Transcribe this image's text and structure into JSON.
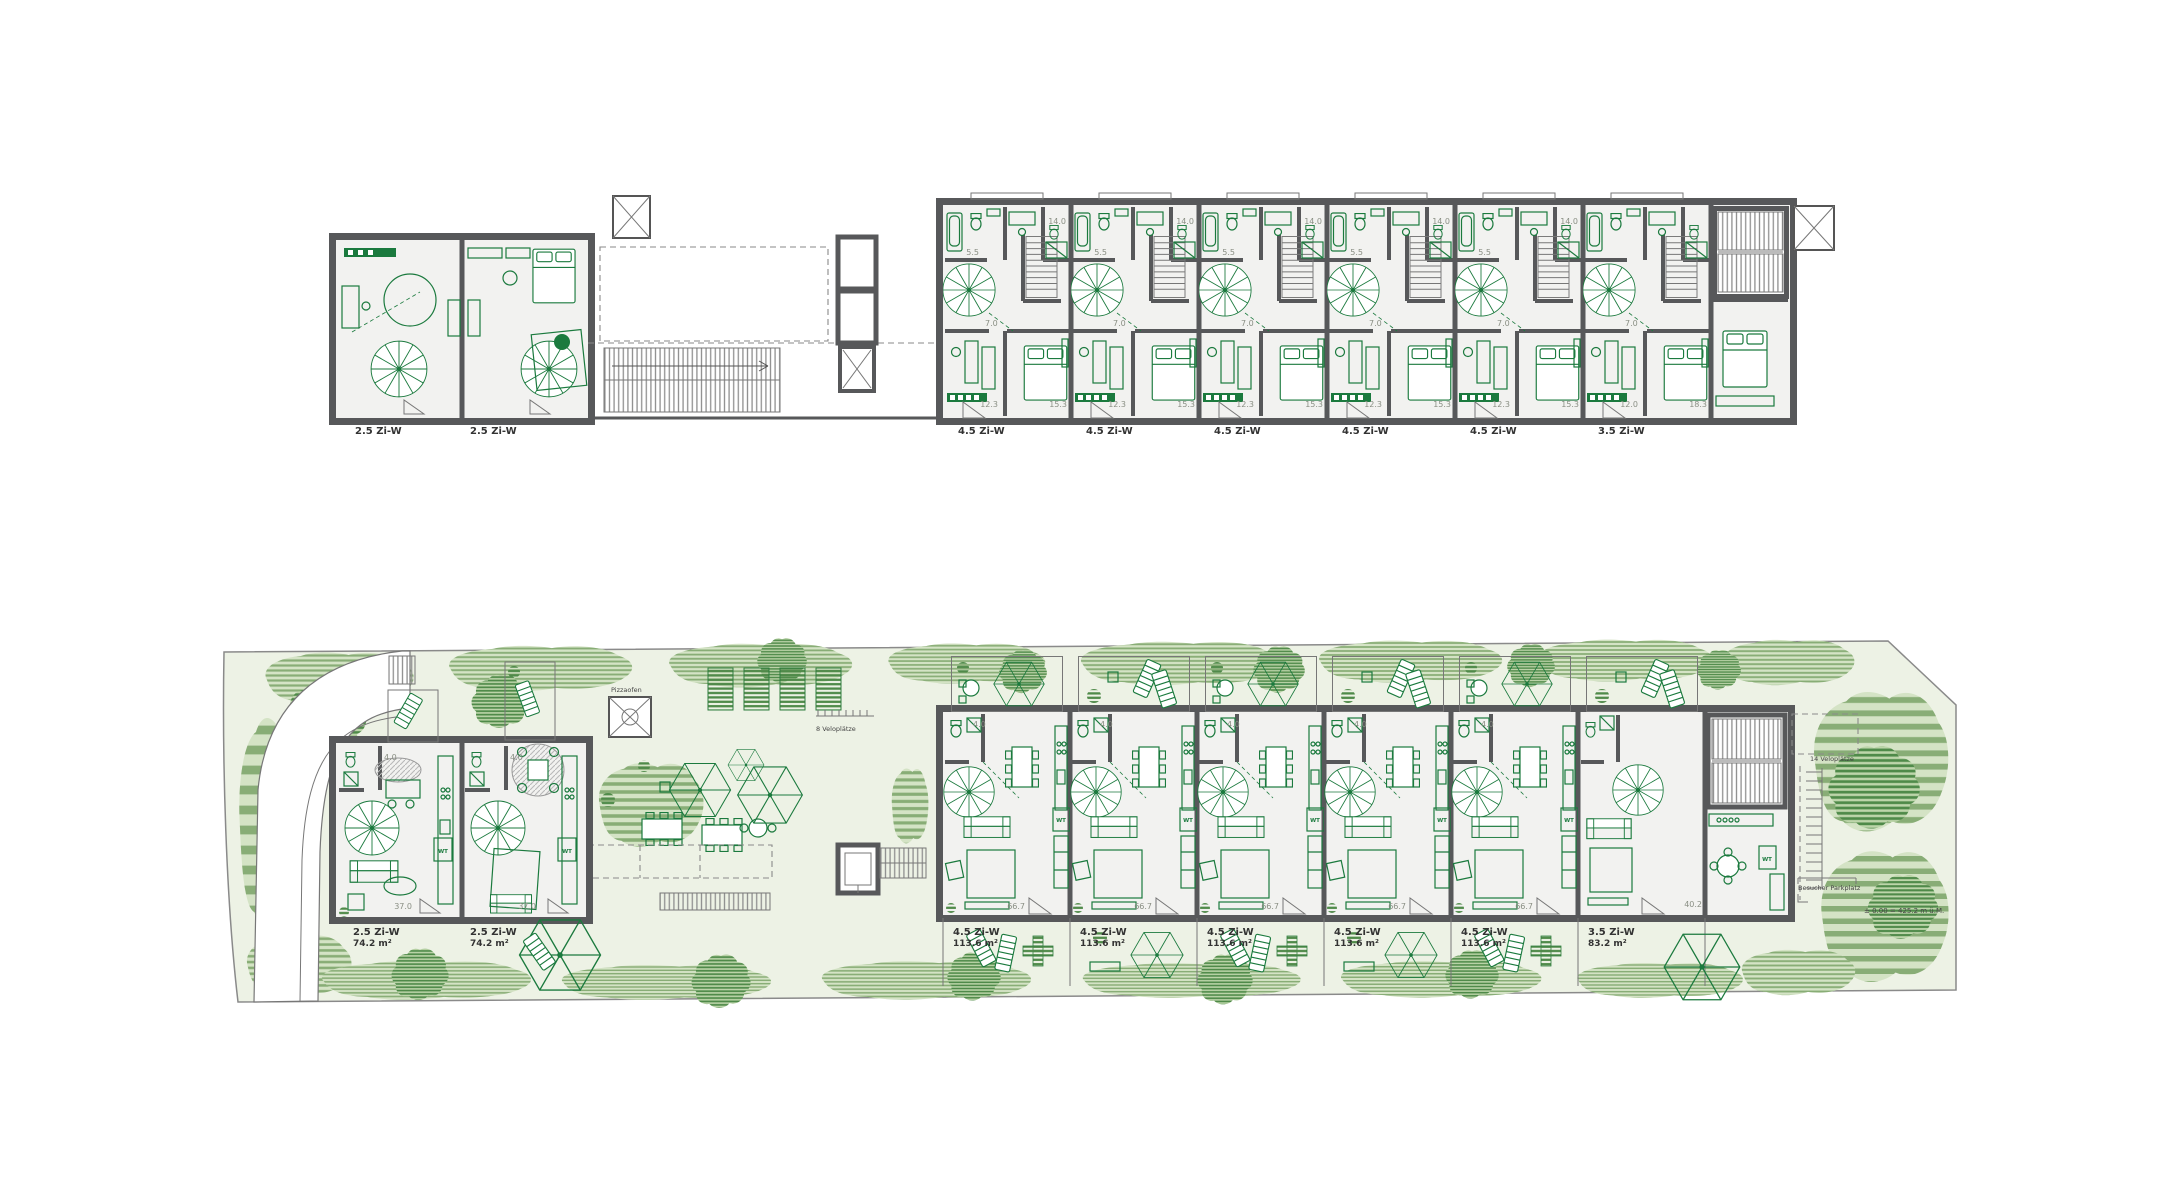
{
  "palette": {
    "ink_green": "#1b7a3e",
    "wall_gray": "#57585a",
    "site_ground": "#edf2e5",
    "veg_stripe": "#88ad76",
    "tree_stripe": "#4f8a49",
    "label_dark": "#333333"
  },
  "upper_plan": {
    "left_unit_labels": [
      "2.5 Zi-W",
      "2.5 Zi-W"
    ],
    "unit_labels": [
      "4.5 Zi-W",
      "4.5 Zi-W",
      "4.5 Zi-W",
      "4.5 Zi-W",
      "4.5 Zi-W",
      "3.5 Zi-W"
    ],
    "room_areas": {
      "bath": "5.5",
      "top_room": "14.0",
      "hall": "7.0",
      "room_small": "12.3",
      "room_large": "15.3",
      "last_room_small": "12.0",
      "last_room_large": "18.3"
    }
  },
  "lower_plan": {
    "left_units": [
      {
        "label": "2.5 Zi-W",
        "area": "74.2 m²"
      },
      {
        "label": "2.5 Zi-W",
        "area": "74.2 m²"
      }
    ],
    "units": [
      {
        "label": "4.5 Zi-W",
        "area": "113.6 m²"
      },
      {
        "label": "4.5 Zi-W",
        "area": "113.6 m²"
      },
      {
        "label": "4.5 Zi-W",
        "area": "113.6 m²"
      },
      {
        "label": "4.5 Zi-W",
        "area": "113.6 m²"
      },
      {
        "label": "4.5 Zi-W",
        "area": "113.6 m²"
      },
      {
        "label": "3.5 Zi-W",
        "area": "83.2 m²"
      }
    ],
    "room_areas": {
      "bath": "4.0",
      "living": "66.7",
      "left_living": "37.0",
      "last_living": "40.2"
    },
    "labels": {
      "pizza_oven": "Pizzaofen",
      "bike_8": "8 Veloplätze",
      "bike_14": "14 Veloplätze",
      "visitor_parking": "Besucher Parkplatz",
      "datum": "± 0.00 = 425.2 m ü.M.",
      "washer": "WT"
    }
  }
}
